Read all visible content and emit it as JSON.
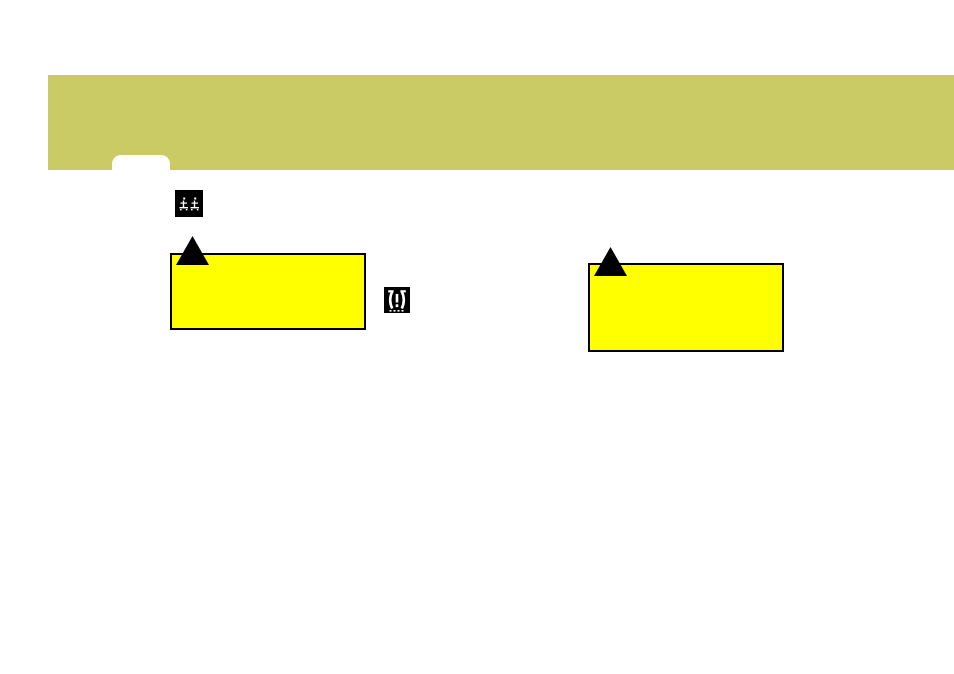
{
  "page": {
    "background_color": "#ffffff"
  },
  "header_band": {
    "color": "#cbcb66",
    "tab_color": "#ffffff"
  },
  "chapter_icon": {
    "name": "two-seated-figures-icon",
    "background_color": "#000000",
    "glyph_color": "#ffffff"
  },
  "warning_triangles": {
    "color": "#000000"
  },
  "highlight_boxes": {
    "fill_color": "#ffff00",
    "border_color": "#000000"
  },
  "tpms_icon": {
    "name": "tire-pressure-warning-icon",
    "background_color": "#000000",
    "glyph_color": "#ffffff"
  }
}
